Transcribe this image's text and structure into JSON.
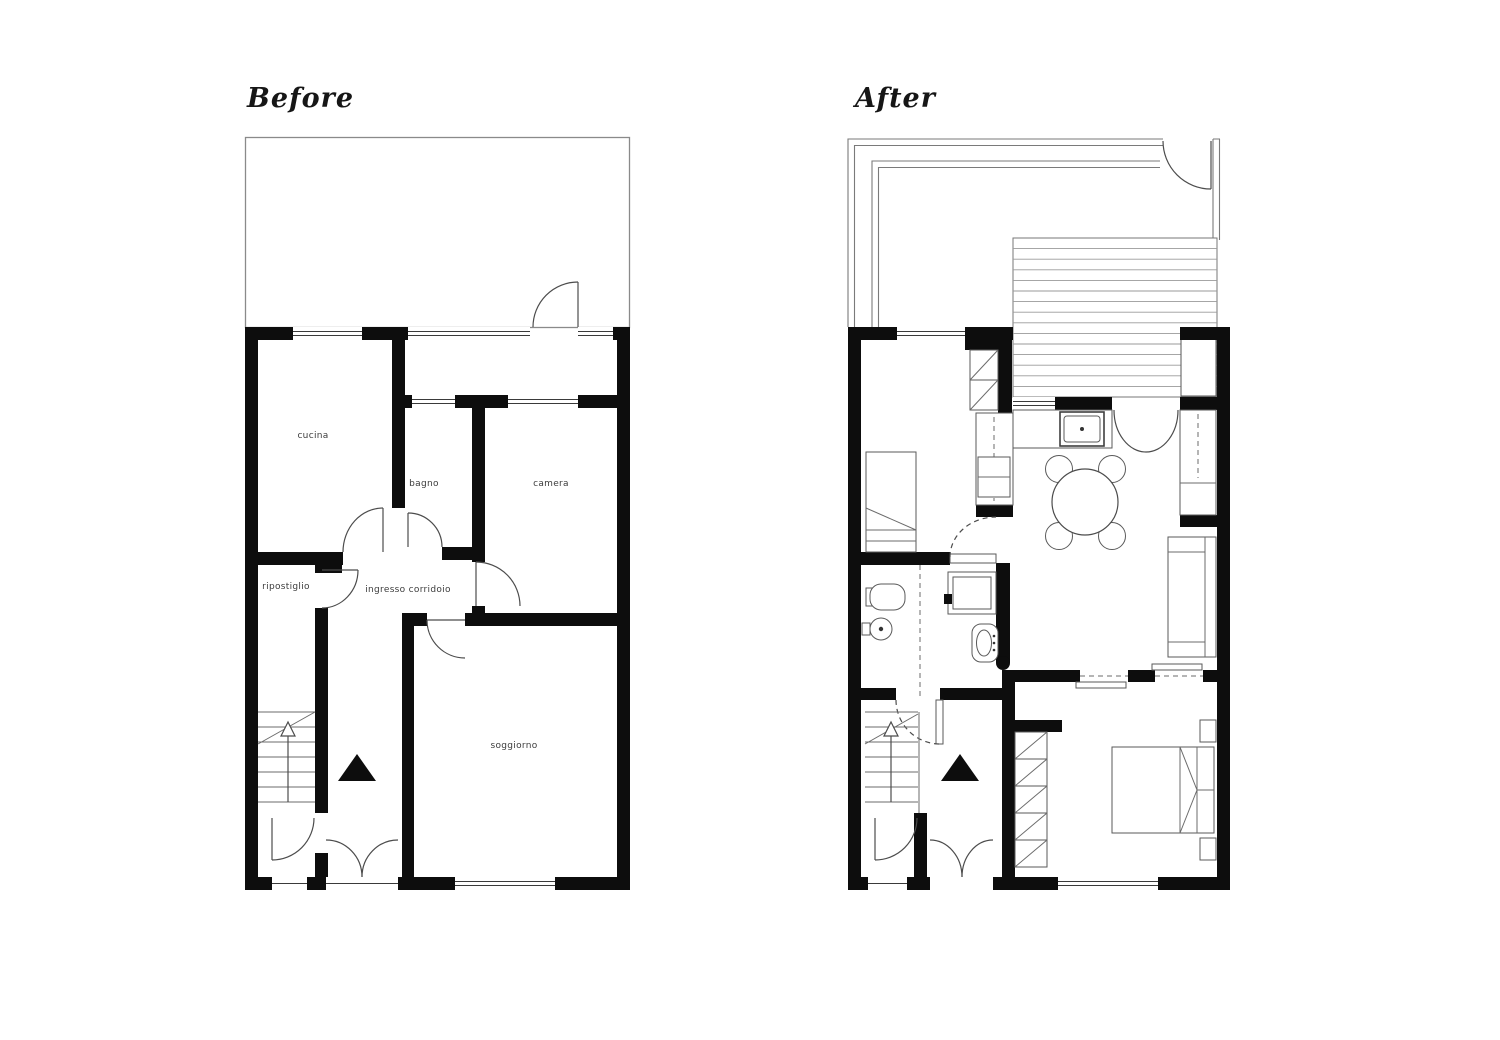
{
  "page": {
    "background": "#ffffff",
    "description": "Before and after renovation floor plans of an apartment"
  },
  "colors": {
    "wall": "#0d0d0d",
    "line": "#4c4c4c",
    "railing": "#7a7a7a",
    "background": "#ffffff"
  },
  "before": {
    "title": "Before",
    "rooms": {
      "cucina": "cucina",
      "bagno": "bagno",
      "camera": "camera",
      "ripostiglio": "ripostiglio",
      "ingresso": "ingresso corridoio",
      "soggiorno": "soggiorno"
    }
  },
  "after": {
    "title": "After"
  },
  "icons": {
    "stairs_direction": "up-arrow-icon",
    "entrance_marker": "filled-triangle-icon"
  }
}
